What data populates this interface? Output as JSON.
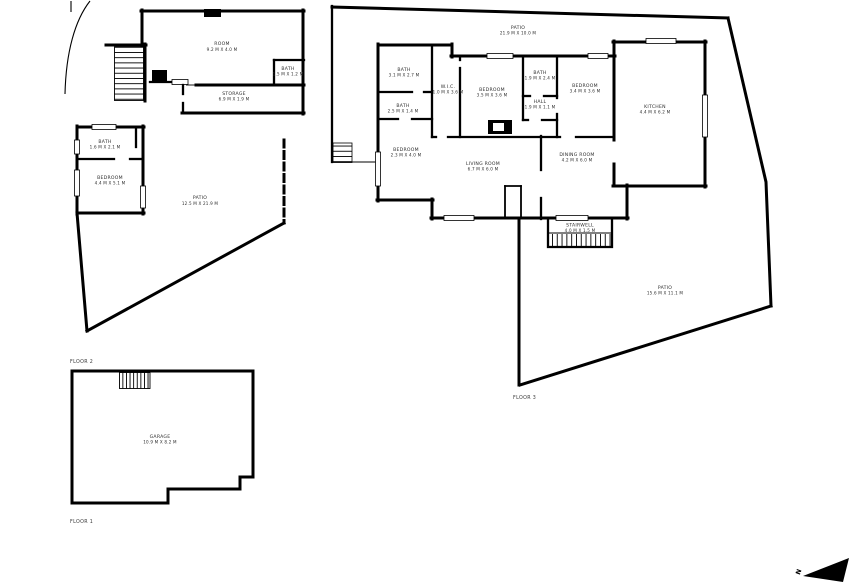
{
  "document_type": "floor-plan",
  "colors": {
    "walls": "#000000",
    "background": "#ffffff",
    "label_text": "#2d2d2d"
  },
  "compass": {
    "north_label": "N"
  },
  "floor2": {
    "label": "FLOOR 2",
    "rooms": {
      "room": {
        "name": "ROOM",
        "dims": "9.2 M X 4.0 M"
      },
      "bath_top": {
        "name": "BATH",
        "dims": "1.5 M X 1.2 M"
      },
      "storage": {
        "name": "STORAGE",
        "dims": "6.9 M X 1.9 M"
      },
      "bath_left": {
        "name": "BATH",
        "dims": "1.6 M X 2.1 M"
      },
      "bedroom": {
        "name": "BEDROOM",
        "dims": "4.4 M X 5.1 M"
      },
      "patio": {
        "name": "PATIO",
        "dims": "12.5 M X 21.9 M"
      }
    }
  },
  "floor3": {
    "label": "FLOOR 3",
    "rooms": {
      "patio_top": {
        "name": "PATIO",
        "dims": "21.9 M X 10.0 M"
      },
      "bath1": {
        "name": "BATH",
        "dims": "3.1 M X 2.7 M"
      },
      "wic": {
        "name": "W.I.C.",
        "dims": "1.0 M X 3.6 M"
      },
      "bedroom1": {
        "name": "BEDROOM",
        "dims": "3.5 M X 3.6 M"
      },
      "bath2": {
        "name": "BATH",
        "dims": "1.9 M X 2.4 M"
      },
      "hall": {
        "name": "HALL",
        "dims": "1.9 M X 1.1 M"
      },
      "bedroom2": {
        "name": "BEDROOM",
        "dims": "3.4 M X 3.6 M"
      },
      "kitchen": {
        "name": "KITCHEN",
        "dims": "4.4 M X 6.2 M"
      },
      "bath3": {
        "name": "BATH",
        "dims": "2.5 M X 1.4 M"
      },
      "bedroom3": {
        "name": "BEDROOM",
        "dims": "2.3 M X 4.0 M"
      },
      "living": {
        "name": "LIVING ROOM",
        "dims": "6.7 M X 6.0 M"
      },
      "dining": {
        "name": "DINING ROOM",
        "dims": "4.2 M X 6.0 M"
      },
      "stairwell": {
        "name": "STAIRWELL",
        "dims": "4.0 M X 1.5 M"
      },
      "patio_bottom": {
        "name": "PATIO",
        "dims": "15.6 M X 11.1 M"
      }
    }
  },
  "floor1": {
    "label": "FLOOR 1",
    "rooms": {
      "garage": {
        "name": "GARAGE",
        "dims": "10.9 M X 8.2 M"
      }
    }
  }
}
